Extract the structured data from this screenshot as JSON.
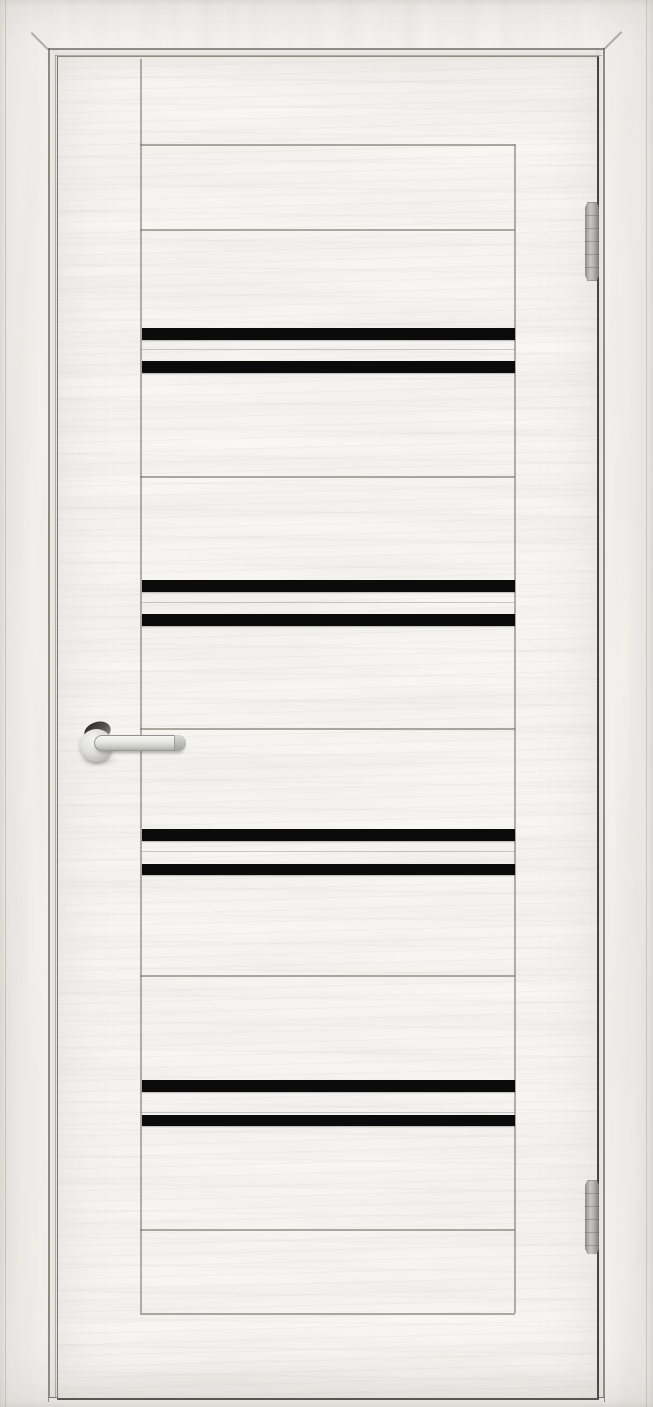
{
  "meta": {
    "type": "product-photo",
    "subject": "Closed white interior door with ash wood-grain finish, eight horizontal black glass inserts arranged in four pairs, satin-chrome lever handle on the left side and two slim barrel hinges on the right side, shown inside a matching white door frame",
    "orientation": "portrait"
  },
  "palette": {
    "wood_white": "#f8f7f3",
    "leaf_white": "#faf9f6",
    "grain_gray": "#b9b5ad",
    "jamb_line": "#6c6a64",
    "leaf_edge_dark": "#45443f",
    "glass_black": "#0b0b0b",
    "hardware_silver": "#c9c7c3",
    "hardware_dark": "#33322f",
    "floor": "#f2f0ec"
  },
  "frame": {
    "inner_left_x": 48,
    "inner_top_y": 48,
    "inner_right_x": 603,
    "second_left_x": 55,
    "second_top_y": 55,
    "outer_left_x": 5,
    "outer_right_x": 646,
    "miter_top_left": {
      "x": 32,
      "y": 32
    },
    "miter_top_right": {
      "x": 604,
      "y": 48
    }
  },
  "door": {
    "left": 57,
    "top": 56,
    "width": 539,
    "height": 1341,
    "panel_left": 82,
    "panel_right": 456,
    "stiles": [
      {
        "x": 82,
        "top": 2,
        "bottom": 1256
      },
      {
        "x": 456,
        "top": 87,
        "bottom": 1256
      }
    ],
    "grooves": [
      {
        "y": 87,
        "kind": "strong"
      },
      {
        "y": 172,
        "kind": "strong"
      },
      {
        "y": 292,
        "kind": "faint"
      },
      {
        "y": 419,
        "kind": "strong"
      },
      {
        "y": 545,
        "kind": "faint"
      },
      {
        "y": 671,
        "kind": "strong"
      },
      {
        "y": 794,
        "kind": "faint"
      },
      {
        "y": 918,
        "kind": "strong"
      },
      {
        "y": 1055,
        "kind": "faint"
      },
      {
        "y": 1172,
        "kind": "strong"
      },
      {
        "y": 1256,
        "kind": "strong"
      }
    ],
    "glass_stripes": [
      {
        "top": 271,
        "height": 12
      },
      {
        "top": 304,
        "height": 12
      },
      {
        "top": 523,
        "height": 12
      },
      {
        "top": 557,
        "height": 12
      },
      {
        "top": 772,
        "height": 12
      },
      {
        "top": 807,
        "height": 11
      },
      {
        "top": 1023,
        "height": 12
      },
      {
        "top": 1058,
        "height": 11
      }
    ]
  },
  "handle": {
    "side": "left",
    "finish": "satin-chrome",
    "type": "lever-on-round-rosette",
    "neck": {
      "left": 84,
      "top": 722,
      "width": 27,
      "height": 19,
      "rotate": -18
    },
    "rosette": {
      "left": 80,
      "top": 729,
      "size": 33
    },
    "lever": {
      "left": 94,
      "top": 735,
      "length": 90,
      "thickness": 14
    },
    "shadow": {
      "left": 79,
      "top": 756,
      "width": 40,
      "height": 10
    }
  },
  "hinges": [
    {
      "x": 585,
      "top": 202,
      "height": 79
    },
    {
      "x": 585,
      "top": 1180,
      "height": 74
    }
  ]
}
